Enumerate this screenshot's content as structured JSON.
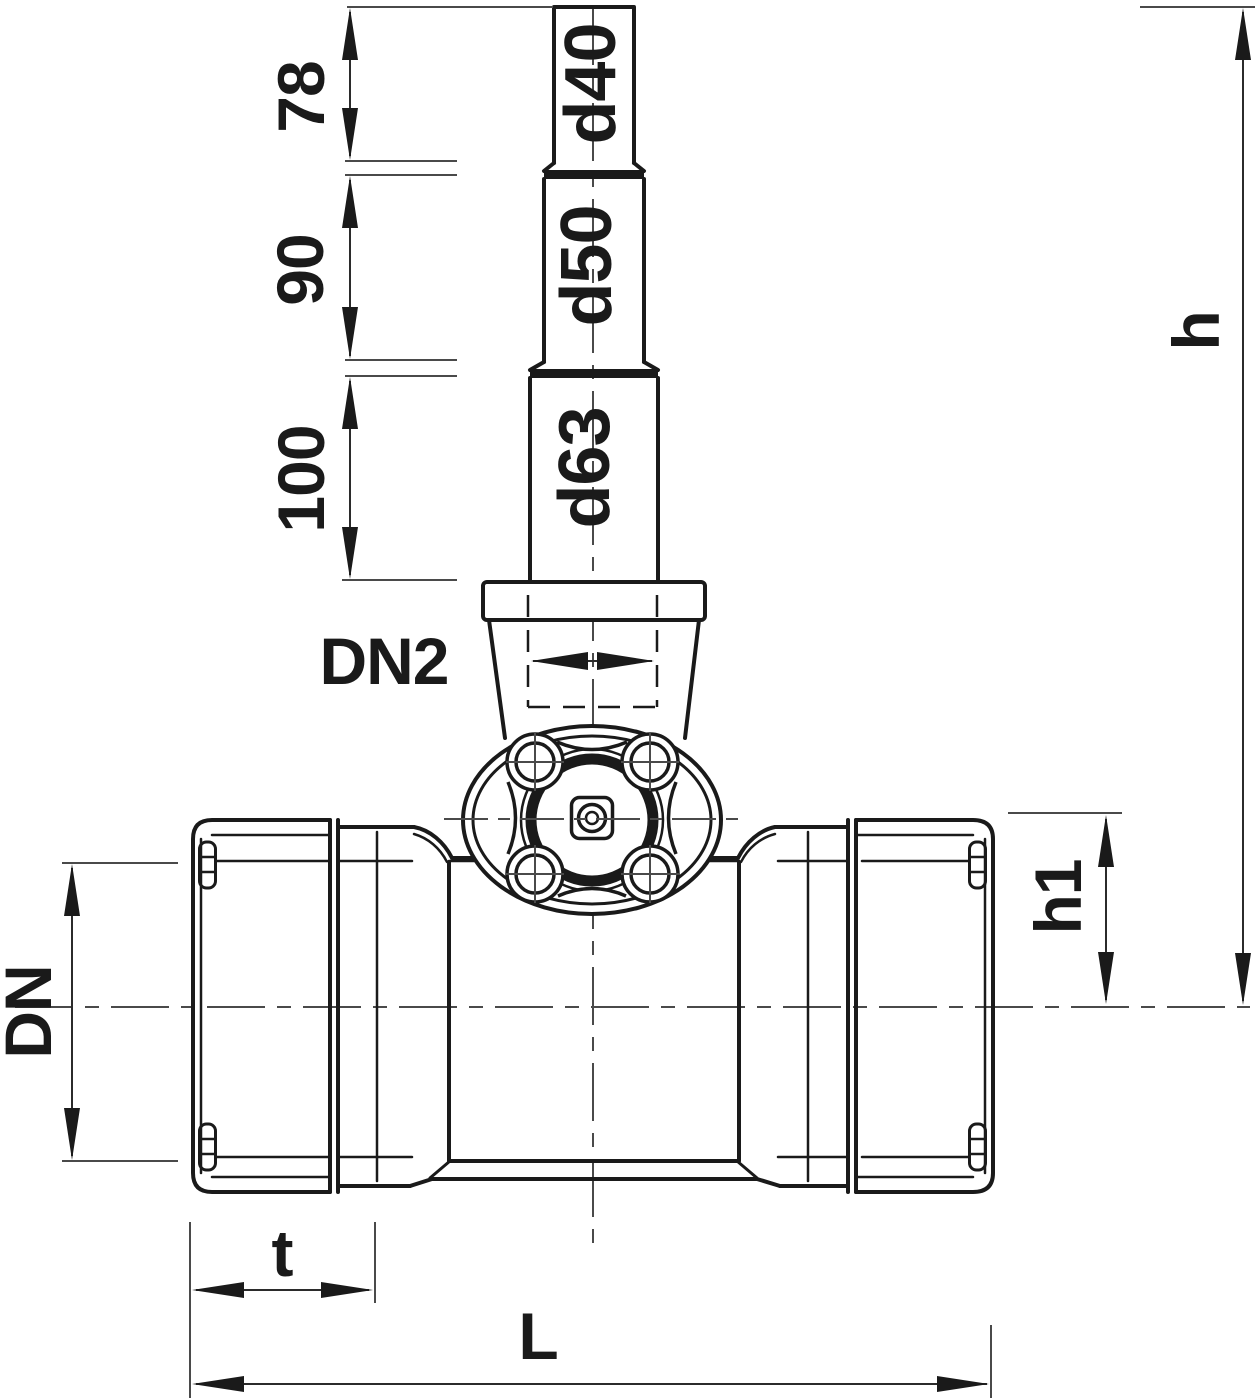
{
  "colors": {
    "background": "#ffffff",
    "line": "#1a1a1a",
    "thin_line": "#4a4a4a"
  },
  "spindle": {
    "sections": [
      {
        "diameter": "d40",
        "length": "78"
      },
      {
        "diameter": "d50",
        "length": "90"
      },
      {
        "diameter": "d63",
        "length": "100"
      }
    ]
  },
  "dimensions": {
    "branch": "DN2",
    "bore": "DN",
    "total_height": "h",
    "axis_height": "h1",
    "insertion_depth": "t",
    "overall_length": "L"
  }
}
